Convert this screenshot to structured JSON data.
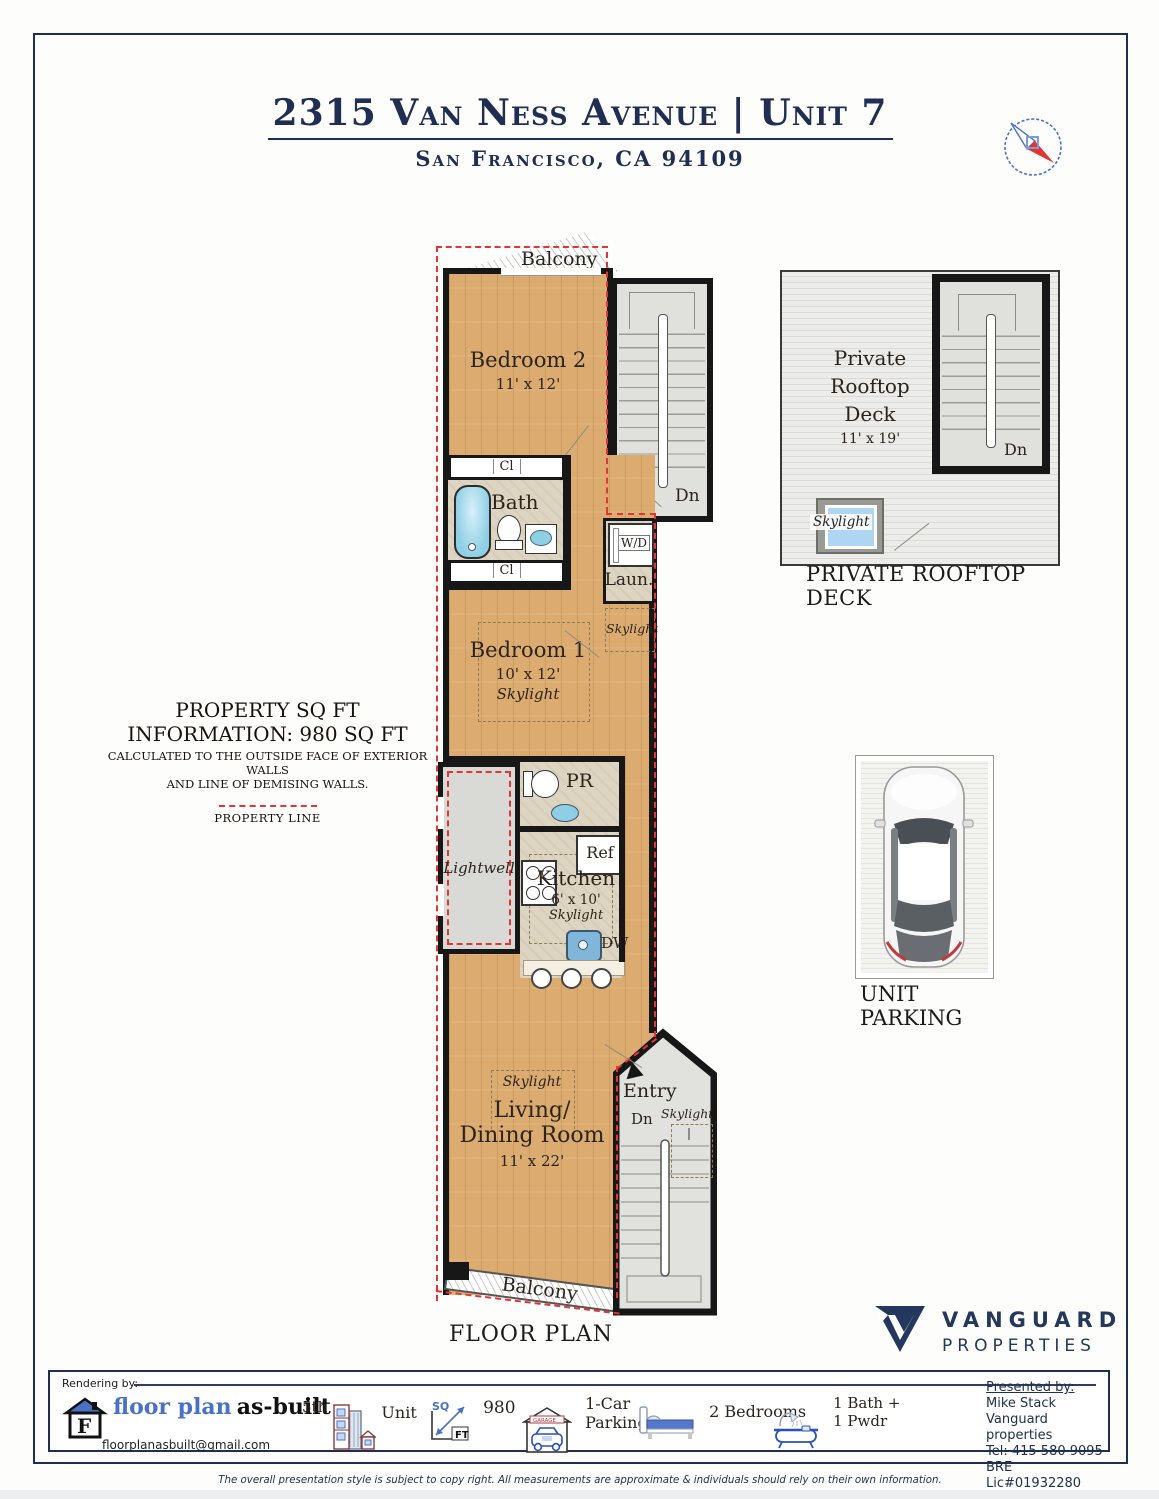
{
  "header": {
    "title": "2315 Van Ness Avenue | Unit 7",
    "subtitle": "San Francisco, CA 94109"
  },
  "fp": {
    "balcony_top": "Balcony",
    "bedroom2_name": "Bedroom 2",
    "bedroom2_dims": "11' x 12'",
    "up": "Up",
    "dn": "Dn",
    "cl_top": "Cl",
    "cl_bottom": "Cl",
    "bath": "Bath",
    "wd": "W/D",
    "laundry": "Laun.",
    "skylight_laundry": "Skylight",
    "bedroom1_name": "Bedroom 1",
    "bedroom1_dims": "10' x 12'",
    "bedroom1_skylight": "Skylight",
    "pr": "PR",
    "lightwell": "Lightwell",
    "ref": "Ref",
    "kitchen_name": "Kitchen",
    "kitchen_dims": "6' x 10'",
    "kitchen_skylight": "Skylight",
    "dw": "DW",
    "living_skylight": "Skylight",
    "living_line1": "Living/",
    "living_line2": "Dining Room",
    "living_dims": "11' x 22'",
    "balcony_bottom": "Balcony",
    "entry": "Entry",
    "entry_dn": "Dn",
    "entry_skylight": "Skylight",
    "caption": "FLOOR PLAN"
  },
  "rooftop": {
    "line1": "Private",
    "line2": "Rooftop",
    "line3": "Deck",
    "dims": "11' x 19'",
    "dn": "Dn",
    "skylight": "Skylight",
    "caption1": "PRIVATE ROOFTOP",
    "caption2": "DECK"
  },
  "parking": {
    "caption1": "UNIT",
    "caption2": "PARKING"
  },
  "info": {
    "line1": "PROPERTY SQ FT",
    "line2": "INFORMATION: 980 SQ FT",
    "line3": "CALCULATED TO THE OUTSIDE FACE OF EXTERIOR WALLS",
    "line4": "AND LINE OF DEMISING WALLS.",
    "legend": "PROPERTY LINE"
  },
  "brand": {
    "word1": "VANGUARD",
    "word2": "PROPERTIES"
  },
  "footer": {
    "rendering_by": "Rendering by:",
    "fpab": {
      "letter": "F",
      "blue": "floor plan",
      "black": "as-built",
      "email": "floorplanasbuilt@gmail.com"
    },
    "floor": {
      "prefix": "5th",
      "label": "Unit"
    },
    "sqft": {
      "sq": "SQ",
      "ft": "FT",
      "value": "980"
    },
    "garage": {
      "mini": "GARAGE",
      "line1": "1-Car",
      "line2": "Parking"
    },
    "bedrooms": {
      "label": "2 Bedrooms"
    },
    "bath": {
      "line1": "1 Bath +",
      "line2": "1 Pwdr"
    },
    "presented": {
      "heading": "Presented by:",
      "name": "Mike Stack",
      "company": "Vanguard properties",
      "tel": "Tel: 415 580 9095",
      "lic": "BRE Lic#01932280"
    }
  },
  "disclaimer": "The overall presentation style is subject to copy right. All measurements are approximate & individuals should rely on their own information.",
  "colors": {
    "navy": "#1f2e52",
    "red": "#e23535",
    "wood": "#dcab6f",
    "icon_blue": "#4a72c4"
  }
}
